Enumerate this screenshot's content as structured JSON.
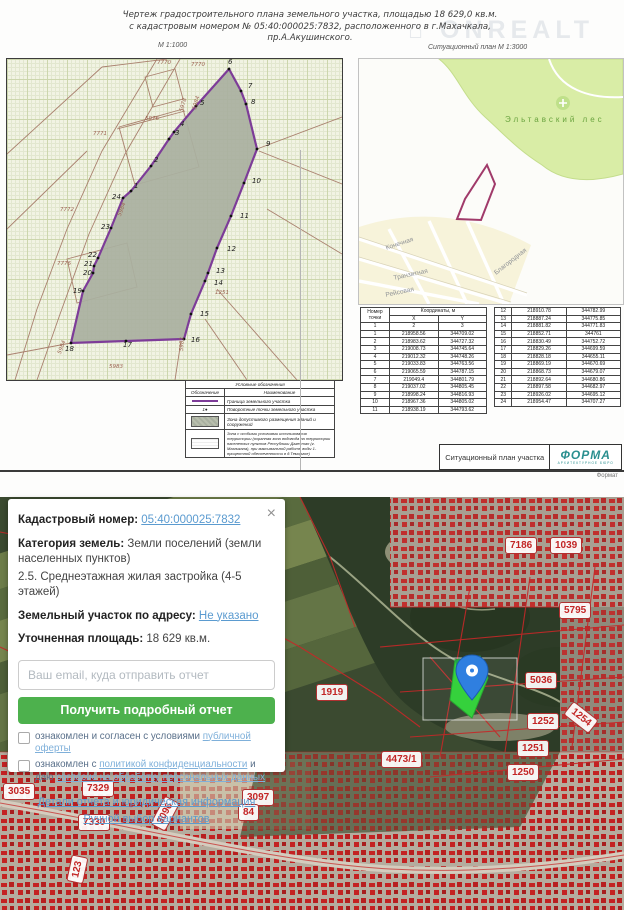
{
  "document": {
    "title_line1": "Чертеж  градостроительного  плана  земельного  участка,    площадью  18 629,0  кв.м.",
    "title_line2": "с  кадастровым  номером     №  05:40:000025:7832,  расположенного  в  г.Махачкала,",
    "title_line3": "пр.А.Акушинского.",
    "scale_left": "М 1:1000",
    "scale_right": "Ситуационный план М 1:3000",
    "watermark": "⌂ ONREALT",
    "format_label": "Формат",
    "titleblock_label": "Ситуационный план участка",
    "logo_text": "ФОРМА",
    "logo_sub": "АРХИТЕКТУРНОЕ БЮРО"
  },
  "plan": {
    "outline": "124,132 144,107 162,80 167,73 189,47 222,10 234,32 239,45 250,90 237,124 224,157 210,189 201,214 198,222 184,255 177,280 119,282 64,284 76,232 86,214 87,207 91,199 104,169 116,139",
    "vertices": [
      {
        "t": "1",
        "x": 127,
        "y": 123
      },
      {
        "t": "2",
        "x": 147,
        "y": 97
      },
      {
        "t": "3",
        "x": 168,
        "y": 70
      },
      {
        "t": "4",
        "x": 173,
        "y": 61
      },
      {
        "t": "5",
        "x": 193,
        "y": 40
      },
      {
        "t": "6",
        "x": 221,
        "y": -1
      },
      {
        "t": "7",
        "x": 241,
        "y": 23
      },
      {
        "t": "8",
        "x": 244,
        "y": 39
      },
      {
        "t": "9",
        "x": 259,
        "y": 81
      },
      {
        "t": "10",
        "x": 245,
        "y": 118
      },
      {
        "t": "11",
        "x": 233,
        "y": 153
      },
      {
        "t": "12",
        "x": 220,
        "y": 186
      },
      {
        "t": "13",
        "x": 209,
        "y": 208
      },
      {
        "t": "14",
        "x": 207,
        "y": 220
      },
      {
        "t": "15",
        "x": 193,
        "y": 251
      },
      {
        "t": "16",
        "x": 184,
        "y": 277
      },
      {
        "t": "17",
        "x": 116,
        "y": 282
      },
      {
        "t": "18",
        "x": 58,
        "y": 286
      },
      {
        "t": "19",
        "x": 66,
        "y": 228
      },
      {
        "t": "20",
        "x": 76,
        "y": 210
      },
      {
        "t": "21",
        "x": 77,
        "y": 201
      },
      {
        "t": "22",
        "x": 81,
        "y": 192
      },
      {
        "t": "23",
        "x": 94,
        "y": 164
      },
      {
        "t": "24",
        "x": 105,
        "y": 134
      }
    ],
    "parcel_numbers": [
      {
        "t": "7770",
        "x": 150,
        "y": 1
      },
      {
        "t": "7770",
        "x": 184,
        "y": 3
      },
      {
        "t": "7771",
        "x": 86,
        "y": 72
      },
      {
        "t": "5976",
        "x": 138,
        "y": 57
      },
      {
        "t": "5978",
        "x": 172,
        "y": 52,
        "r": -75
      },
      {
        "t": "5984",
        "x": 185,
        "y": 50,
        "r": -75
      },
      {
        "t": "7772",
        "x": 53,
        "y": 148
      },
      {
        "t": "5984",
        "x": 110,
        "y": 156,
        "r": -70
      },
      {
        "t": "7776",
        "x": 50,
        "y": 202
      },
      {
        "t": "1251",
        "x": 208,
        "y": 231
      },
      {
        "t": "5983",
        "x": 172,
        "y": 292,
        "r": -87
      },
      {
        "t": "5984",
        "x": 50,
        "y": 294,
        "r": -70
      },
      {
        "t": "5983",
        "x": 102,
        "y": 305
      }
    ]
  },
  "sit_plan": {
    "forest_label": "Эльтавский лес",
    "outline": "128,106 136,125 122,161 98,160 106,140",
    "streets": [
      {
        "t": "Конечная",
        "x": 26,
        "y": 186,
        "r": -18
      },
      {
        "t": "Транзитная",
        "x": 34,
        "y": 216,
        "r": -12
      },
      {
        "t": "Рейсовая",
        "x": 26,
        "y": 233,
        "r": -12
      },
      {
        "t": "Благородная",
        "x": 134,
        "y": 212,
        "r": -38
      }
    ]
  },
  "tables": {
    "header": {
      "col_point": "Номер точки",
      "coords": "Координаты, м",
      "x": "X",
      "y": "Y",
      "n1": "1",
      "n2": "2",
      "n3": "3"
    },
    "left_rows": [
      [
        "1",
        "218958.56",
        "344709.02"
      ],
      [
        "2",
        "218983.62",
        "344727.32"
      ],
      [
        "3",
        "219008.73",
        "344745.64"
      ],
      [
        "4",
        "219012.32",
        "344748.26"
      ],
      [
        "5",
        "219033.83",
        "344763.56"
      ],
      [
        "6",
        "219065.59",
        "344787.15"
      ],
      [
        "7",
        "219049.4",
        "344801.79"
      ],
      [
        "8",
        "219037.02",
        "344805.45"
      ],
      [
        "9",
        "218998.24",
        "344816.93"
      ],
      [
        "10",
        "218967.36",
        "344805.02"
      ],
      [
        "11",
        "218938.19",
        "344793.62"
      ]
    ],
    "right_rows": [
      [
        "12",
        "218910.78",
        "344782.99"
      ],
      [
        "13",
        "218887.24",
        "344775.85"
      ],
      [
        "14",
        "218881.82",
        "344771.83"
      ],
      [
        "15",
        "218852.71",
        "344761"
      ],
      [
        "16",
        "218830.49",
        "344752.72"
      ],
      [
        "17",
        "218829.26",
        "344699.59"
      ],
      [
        "18",
        "218828.18",
        "344655.11"
      ],
      [
        "19",
        "218869.19",
        "344670.69"
      ],
      [
        "20",
        "218868.73",
        "344679.07"
      ],
      [
        "21",
        "218892.64",
        "344680.86"
      ],
      [
        "22",
        "218897.58",
        "344682.97"
      ],
      [
        "23",
        "218926.02",
        "344695.12"
      ],
      [
        "24",
        "218954.47",
        "344707.27"
      ]
    ]
  },
  "legend": {
    "title": "Условные обозначения",
    "col1": "Обозначение",
    "col2": "Наименование",
    "row1": "Граница земельного участка",
    "row2": "Поворотные точки земельного участка",
    "row2_sym": "1●",
    "row3": "Зона допустимого размещения зданий и сооружений",
    "row4": "Зона с особыми условиями использования территории (охранная зона водовода на территории населенных пунктов Республики Дагестан (г. Махачкала), при максимальной работе воды 1-процентной обеспеченности в д.Темиргое)"
  },
  "map": {
    "selection": {
      "x": "423",
      "y": "161",
      "w": "94",
      "h": "62"
    },
    "parcel_green": "455,163 480,159 488,181 472,221 450,203",
    "parcel_green_dark": "455,163 480,159 484,171 458,178",
    "labels": [
      {
        "t": "7186",
        "x": 505,
        "y": 40
      },
      {
        "t": "1039",
        "x": 550,
        "y": 40
      },
      {
        "t": "5795",
        "x": 559,
        "y": 105
      },
      {
        "t": "5036",
        "x": 525,
        "y": 175
      },
      {
        "t": "1919",
        "x": 316,
        "y": 187
      },
      {
        "t": "1252",
        "x": 527,
        "y": 216
      },
      {
        "t": "1254",
        "x": 565,
        "y": 212,
        "r": 38
      },
      {
        "t": "1251",
        "x": 517,
        "y": 243
      },
      {
        "t": "1250",
        "x": 507,
        "y": 267
      },
      {
        "t": "4473/1",
        "x": 381,
        "y": 254
      },
      {
        "t": "3035",
        "x": 3,
        "y": 286
      },
      {
        "t": "7329",
        "x": 82,
        "y": 283
      },
      {
        "t": "7330",
        "x": 78,
        "y": 317
      },
      {
        "t": "3096",
        "x": 149,
        "y": 308,
        "r": -62
      },
      {
        "t": "3097",
        "x": 242,
        "y": 292
      },
      {
        "t": "84",
        "x": 238,
        "y": 307
      },
      {
        "t": "123",
        "x": 64,
        "y": 364,
        "r": -78
      }
    ]
  },
  "card": {
    "close": "×",
    "kad_label": "Кадастровый номер:",
    "kad_value": "05:40:000025:7832",
    "cat_label": "Категория земель:",
    "cat_value": " Земли поселений (земли населенных пунктов)",
    "zone_line": "2.5. Среднеэтажная жилая застройка (4-5 этажей)",
    "addr_label": "Земельный участок по адресу:",
    "addr_value": "Не указано",
    "area_label": "Уточненная площадь:",
    "area_value": " 18 629 кв.м.",
    "email_placeholder": "Ваш email, куда отправить отчет",
    "button_label": "Получить подробный отчет",
    "cb1_pre": "ознакомлен и согласен с условиями ",
    "cb1_link": "публичной оферты",
    "cb2_pre": "ознакомлен с ",
    "cb2_link1": "политикой конфиденциальности",
    "cb2_mid": " и даю ",
    "cb2_link2": "согласие на обработку персональных данных",
    "link_details": "Детали отчета и юридическая информация",
    "link_manual": "Ручной выбор вариантов"
  }
}
